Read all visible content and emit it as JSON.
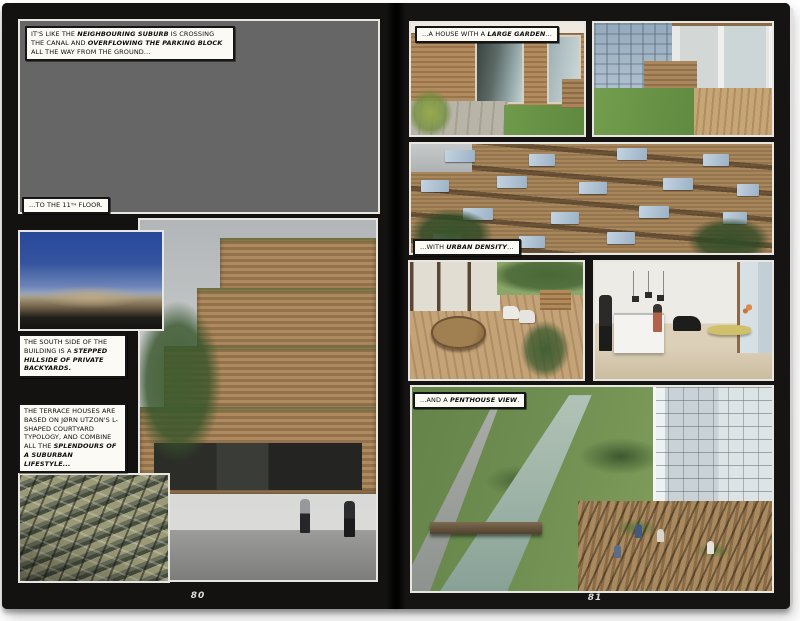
{
  "book": {
    "pages": {
      "left": {
        "number": "80",
        "captions": {
          "suburb": [
            {
              "t": "IT'S LIKE THE "
            },
            {
              "t": "NEIGHBOURING SUBURB",
              "b": true
            },
            {
              "t": " IS CROSSING THE CANAL AND "
            },
            {
              "t": "OVERFLOWING THE PARKING BLOCK",
              "b": true
            },
            {
              "t": " ALL THE WAY FROM THE GROUND..."
            }
          ],
          "floor": [
            {
              "t": "...TO THE 11"
            },
            {
              "t": "TH",
              "sup": true
            },
            {
              "t": " FLOOR."
            }
          ],
          "south_side": [
            {
              "t": "THE SOUTH SIDE OF THE BUILDING IS A "
            },
            {
              "t": "STEPPED HILLSIDE OF PRIVATE BACKYARDS.",
              "b": true
            }
          ],
          "terrace_houses": [
            {
              "t": "THE TERRACE HOUSES ARE BASED ON JØRN UTZON'S L-SHAPED COURTYARD TYPOLOGY, AND COMBINE ALL THE "
            },
            {
              "t": "SPLENDOURS OF A SUBURBAN LIFESTYLE...",
              "b": true
            }
          ]
        },
        "photos": {
          "aerial": "aerial view of wooden pergola terraces overflowing toward suburb",
          "model": "model of the mountain building under blue sky",
          "stepped": "stepped wooden facade with private backyard terraces",
          "grid": "aerial grid of l-shaped courtyard terrace houses"
        }
      },
      "right": {
        "number": "81",
        "captions": {
          "large_garden": [
            {
              "t": "...A HOUSE WITH A "
            },
            {
              "t": "LARGE GARDEN",
              "b": true
            },
            {
              "t": "..."
            }
          ],
          "urban_density": [
            {
              "t": "...WITH "
            },
            {
              "t": "URBAN DENSITY",
              "b": true
            },
            {
              "t": "..."
            }
          ],
          "penthouse_view": [
            {
              "t": "...AND A "
            },
            {
              "t": "PENTHOUSE VIEW",
              "b": true
            },
            {
              "t": "."
            }
          ]
        },
        "photos": {
          "terrace_doors": "wooden house terrace with sliding glass doors",
          "garden": "roof garden lawn with glass pavilion",
          "facade": "wooden terraced facade with glass balustrades",
          "deck": "wooden deck with round picnic table",
          "kitchen": "white kitchen interior with dining table",
          "canal": "penthouse view over canal and green landscape"
        }
      }
    },
    "colors": {
      "paper": "#ffffff",
      "page_black": "#131211",
      "caption_bg": "#fbfaf5",
      "caption_border": "#151515",
      "page_number": "#dcdcdc"
    }
  }
}
